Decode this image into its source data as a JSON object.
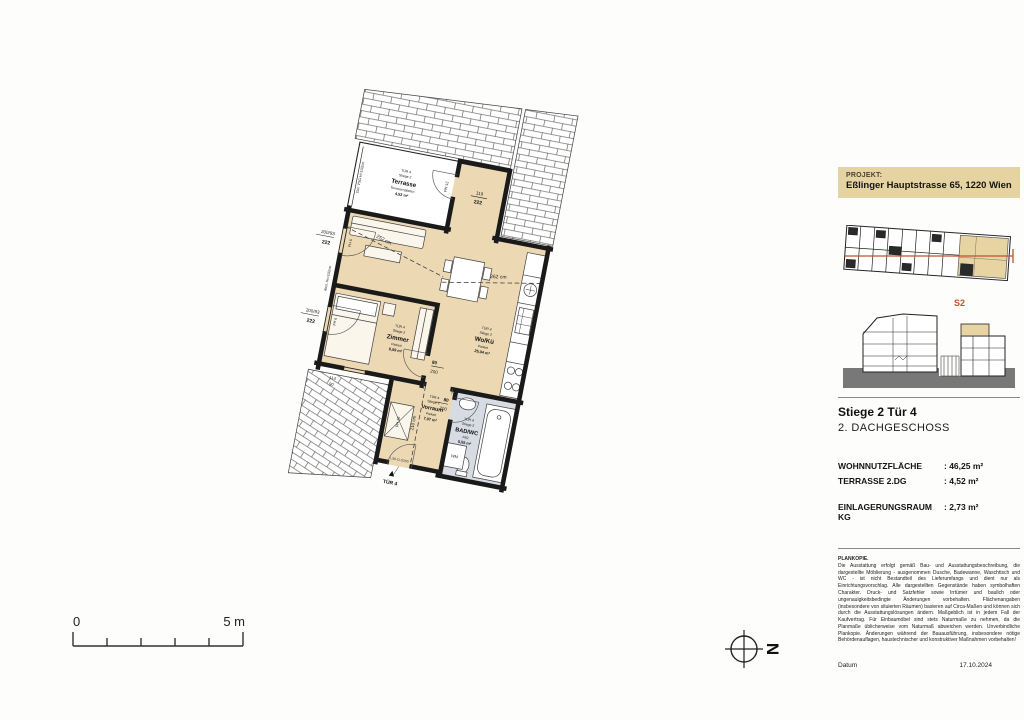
{
  "sidebar": {
    "project_label": "PROJEKT:",
    "project_value": "Eßlinger Hauptstrasse 65, 1220 Wien",
    "section_label": "S2",
    "unit_title": "Stiege 2 Tür 4",
    "unit_floor": "2. DACHGESCHOSS",
    "metrics": [
      {
        "label": "WOHNNUTZFLÄCHE",
        "value": ": 46,25 m²"
      },
      {
        "label": "TERRASSE  2.DG",
        "value": ": 4,52 m²"
      },
      {
        "label": "EINLAGERUNGSRAUM KG",
        "value": ": 2,73 m²"
      }
    ],
    "fineprint_title": "PLANKOPIE.",
    "fineprint_body": "Die Ausstattung erfolgt gemäß Bau- und Ausstattungsbeschreibung, die dargestellte Möblierung - ausgenommen Dusche, Badewanne, Waschtisch und WC - ist nicht Bestandteil des Lieferumfangs und dient nur als Einrichtungsvorschlag. Alle dargestellten Gegenstände haben symbolhaften Charakter. Druck- und Satzfehler sowie Irrtümer und baulich oder ungenauigkeitsbedingte Änderungen vorbehalten. Flächenangaben (insbesondere von situierten Räumen) basieren auf Circa-Maßen und können sich durch die Ausstattungslösungen ändern. Maßgeblich ist in jedem Fall der Kaufvertrag. Für Einbaumöbel sind stets Naturmaße zu nehmen, da die Planmaße üblicherweise vom Naturmaß abweichen werden. Unverbindliche Plankopie. Änderungen während der Bauausführung, insbesondere nötige Behördenauflagen, haustechnischer und konstruktiver Maßnahmen vorbehalten!",
    "datum_label": "Datum",
    "datum_value": "17.10.2024"
  },
  "scalebar": {
    "zero": "0",
    "five": "5 m"
  },
  "north": {
    "label": "N"
  },
  "plan": {
    "rooms": {
      "terrasse": {
        "l1": "TÜR 4",
        "l2": "Stiege 2",
        "name": "Terrasse",
        "floor": "Terrassenplatten",
        "area": "4,52 m²"
      },
      "wokue": {
        "l1": "TÜR 4",
        "l2": "Stiege 2",
        "name": "Wo/Kü",
        "floor": "Parkett",
        "area": "25,04 m²"
      },
      "zimmer": {
        "l1": "TÜR 4",
        "l2": "Stiege 2",
        "name": "Zimmer",
        "floor": "Parkett",
        "area": "8,59 m²"
      },
      "vorraum": {
        "l1": "TÜR 4",
        "l2": "Stiege 2",
        "name": "Vorraum",
        "floor": "Parkett",
        "area": "7,07 m²"
      },
      "badwc": {
        "l1": "TÜR 4",
        "l2": "Stiege 2",
        "name": "BAD/WC",
        "floor": "FB2",
        "area": "5,55 m²"
      }
    },
    "dims": {
      "d119": "119",
      "d222": "222",
      "w200": "200/93",
      "w222": "222",
      "d80": "80",
      "d200": "200",
      "d114": "114",
      "d90": "90",
      "h252": "252 cm",
      "h262": "262 cm",
      "h210": "210 cm",
      "ph12": "PH 12",
      "fh6": "FH 6",
      "ph16": "PH 16",
      "gel": "Gel. VSG H=102cm",
      "abst": "Abst. Hs=102cm",
      "wm": "WM",
      "fire": "L30-O-S200",
      "entry": "TÜR 4"
    }
  },
  "colors": {
    "room_beige": "#ecd9b4",
    "bath_blue": "#d7dbe4",
    "wall_black": "#1a1a1a",
    "accent_orange": "#c0522a",
    "header_beige": "#e6d3a2"
  }
}
